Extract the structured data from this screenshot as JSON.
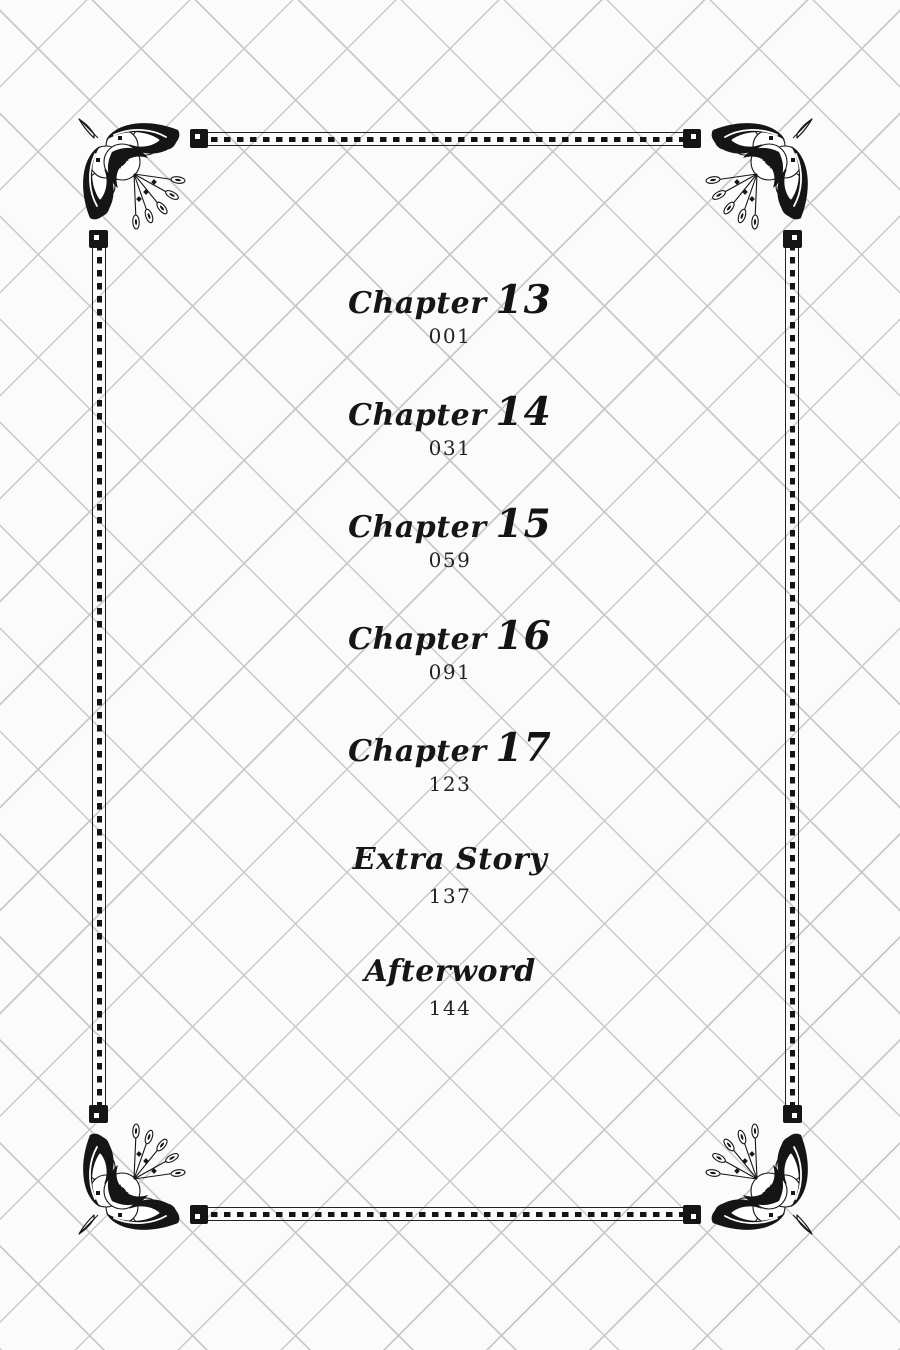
{
  "page": {
    "kind": "book-table-of-contents",
    "paper_color": "#fbfbfb",
    "lattice_line_color": "#c9c9c9",
    "ink_color": "#141414"
  },
  "toc": {
    "entries": [
      {
        "label": "Chapter",
        "number": "13",
        "page": "001"
      },
      {
        "label": "Chapter",
        "number": "14",
        "page": "031"
      },
      {
        "label": "Chapter",
        "number": "15",
        "page": "059"
      },
      {
        "label": "Chapter",
        "number": "16",
        "page": "091"
      },
      {
        "label": "Chapter",
        "number": "17",
        "page": "123"
      },
      {
        "label": "Extra Story",
        "number": "",
        "page": "137"
      },
      {
        "label": "Afterword",
        "number": "",
        "page": "144"
      }
    ]
  },
  "ornaments": {
    "corner_icon": "floral-flourish",
    "border_style": "dashed-film-strip"
  }
}
